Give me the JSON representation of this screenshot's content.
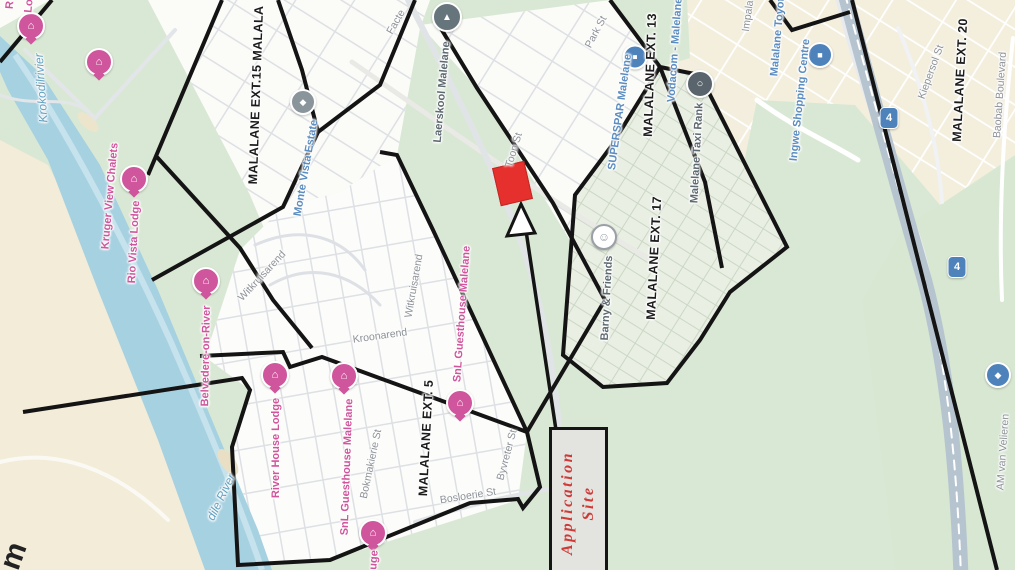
{
  "title": "Malalane locality map with application site",
  "canvas": {
    "width": 1015,
    "height": 570
  },
  "map": {
    "road_shield": "4",
    "annotation": {
      "line1": "Application",
      "line2": "Site"
    },
    "colors": {
      "site_marker": "#e6302d",
      "annotation_text": "#cf3a37",
      "boundary": "#141414",
      "river": "#a6d1e1",
      "green": "#d9e8d4",
      "sand": "#f2ecd9",
      "lodge_pink": "#cf559c",
      "business_blue": "#5c8dc0",
      "street_gray": "#8d9298",
      "highway": "#b6c4d0"
    },
    "labels": [
      {
        "name": "label-ext15",
        "cls": "ext",
        "text": "MALALANE EXT.15 MALALA",
        "x": 256,
        "y": 95,
        "rot": -88
      },
      {
        "name": "label-ext13",
        "cls": "ext",
        "text": "MALALANE EXT. 13",
        "x": 650,
        "y": 75,
        "rot": -88
      },
      {
        "name": "label-ext17",
        "cls": "ext",
        "text": "MALALANE EXT. 17",
        "x": 654,
        "y": 258,
        "rot": -87
      },
      {
        "name": "label-ext20",
        "cls": "ext",
        "text": "MALALANE EXT. 20",
        "x": 960,
        "y": 80,
        "rot": -87
      },
      {
        "name": "label-ext5",
        "cls": "ext",
        "text": "MALALANE EXT. 5",
        "x": 426,
        "y": 438,
        "rot": -87
      },
      {
        "name": "label-kroonarend",
        "cls": "street",
        "text": "Kroonarend",
        "x": 380,
        "y": 336,
        "rot": -8
      },
      {
        "name": "label-witkruisarend-west",
        "cls": "street",
        "text": "Witkruisarend",
        "x": 262,
        "y": 276,
        "rot": -47
      },
      {
        "name": "label-witkruisarend-east",
        "cls": "street",
        "text": "Witkruisarend",
        "x": 414,
        "y": 286,
        "rot": -80
      },
      {
        "name": "label-bokmakierie-st",
        "cls": "street",
        "text": "Bokmakierie St",
        "x": 371,
        "y": 464,
        "rot": -78
      },
      {
        "name": "label-bosloerie-st",
        "cls": "street",
        "text": "Bosloerie St",
        "x": 468,
        "y": 496,
        "rot": -9
      },
      {
        "name": "label-byvreter-st",
        "cls": "street",
        "text": "Byvreter St",
        "x": 507,
        "y": 455,
        "rot": -75
      },
      {
        "name": "label-toon-st",
        "cls": "street",
        "text": "Toon St",
        "x": 514,
        "y": 150,
        "rot": -73
      },
      {
        "name": "label-park-st",
        "cls": "street",
        "text": "Park St",
        "x": 596,
        "y": 32,
        "rot": -62
      },
      {
        "name": "label-impala-st",
        "cls": "street",
        "text": "Impala",
        "x": 748,
        "y": 16,
        "rot": -82
      },
      {
        "name": "label-kiepersol-st",
        "cls": "street",
        "text": "Kiepersol St",
        "x": 931,
        "y": 72,
        "rot": -70
      },
      {
        "name": "label-baobab-boulevard",
        "cls": "street",
        "text": "Baobab Boulevard",
        "x": 1000,
        "y": 95,
        "rot": -86
      },
      {
        "name": "label-am-van-velieren",
        "cls": "street",
        "text": "AM van Velieren",
        "x": 1003,
        "y": 452,
        "rot": -86
      },
      {
        "name": "label-road-fragment",
        "cls": "street",
        "text": "Facte",
        "x": 396,
        "y": 22,
        "rot": -60
      },
      {
        "name": "label-krokodilrivier",
        "cls": "water",
        "text": "Krokodilrivier",
        "x": 41,
        "y": 88,
        "rot": -94
      },
      {
        "name": "label-crocodile-river",
        "cls": "water",
        "text": "dile River",
        "x": 221,
        "y": 497,
        "rot": -64
      },
      {
        "name": "label-kruger-view-chalets",
        "cls": "pink",
        "text": "Kruger View Chalets",
        "x": 110,
        "y": 196,
        "rot": -85
      },
      {
        "name": "label-rio-vista-lodge",
        "cls": "pink",
        "text": "Rio Vista Lodge",
        "x": 134,
        "y": 242,
        "rot": -87
      },
      {
        "name": "label-belvedere-on-river",
        "cls": "pink",
        "text": "Belvedere-on-River",
        "x": 206,
        "y": 356,
        "rot": -89
      },
      {
        "name": "label-river-house-lodge",
        "cls": "pink",
        "text": "River House Lodge",
        "x": 276,
        "y": 448,
        "rot": -90
      },
      {
        "name": "label-snl-guesthouse-west",
        "cls": "pink",
        "text": "SnL Guesthouse Malelane",
        "x": 347,
        "y": 467,
        "rot": -88
      },
      {
        "name": "label-snl-guesthouse-east",
        "cls": "pink",
        "text": "SnL Guesthouse Malelane",
        "x": 462,
        "y": 314,
        "rot": -86
      },
      {
        "name": "label-lodge-fragment",
        "cls": "pink",
        "text": "uge",
        "x": 374,
        "y": 560,
        "rot": -86
      },
      {
        "name": "label-corner-fragment-r",
        "cls": "pink",
        "text": "R",
        "x": 10,
        "y": 5,
        "rot": -85
      },
      {
        "name": "label-corner-fragment-lo",
        "cls": "pink",
        "text": "Lo",
        "x": 29,
        "y": 6,
        "rot": -85
      },
      {
        "name": "label-monte-vista-estate",
        "cls": "biz",
        "text": "Monte Vista Estate",
        "x": 306,
        "y": 168,
        "rot": -80
      },
      {
        "name": "label-superspar",
        "cls": "biz",
        "text": "SUPERSPAR Malelane",
        "x": 620,
        "y": 112,
        "rot": -82
      },
      {
        "name": "label-vodacom",
        "cls": "biz",
        "text": "Vodacom - Malelane",
        "x": 675,
        "y": 50,
        "rot": -86
      },
      {
        "name": "label-malalane-toyota",
        "cls": "biz",
        "text": "Malalane Toyota",
        "x": 778,
        "y": 34,
        "rot": -85
      },
      {
        "name": "label-ingwe-shopping-centre",
        "cls": "biz",
        "text": "Ingwe Shopping Centre",
        "x": 800,
        "y": 100,
        "rot": -84
      },
      {
        "name": "label-laerskool-malelane",
        "cls": "poi",
        "text": "Laerskool Malelane",
        "x": 442,
        "y": 92,
        "rot": -85
      },
      {
        "name": "label-malelane-taxi-rank",
        "cls": "poi",
        "text": "Malelane Taxi Rank",
        "x": 697,
        "y": 153,
        "rot": -87
      },
      {
        "name": "label-barny-and-friends",
        "cls": "poi",
        "text": "Barny & Friends",
        "x": 607,
        "y": 298,
        "rot": -87
      },
      {
        "name": "label-edge-fragment-m",
        "cls": "bigfrag",
        "text": "m",
        "x": 14,
        "y": 556,
        "rot": -70
      }
    ],
    "icons": [
      {
        "name": "lodge-icon",
        "type": "lodge",
        "x": 31,
        "y": 26
      },
      {
        "name": "lodge-icon",
        "type": "lodge",
        "x": 99,
        "y": 62
      },
      {
        "name": "lodge-icon",
        "type": "lodge",
        "x": 134,
        "y": 179
      },
      {
        "name": "lodge-icon",
        "type": "lodge",
        "x": 206,
        "y": 281
      },
      {
        "name": "lodge-icon",
        "type": "lodge",
        "x": 275,
        "y": 375
      },
      {
        "name": "lodge-icon",
        "type": "lodge",
        "x": 344,
        "y": 376
      },
      {
        "name": "lodge-icon",
        "type": "lodge",
        "x": 460,
        "y": 403
      },
      {
        "name": "lodge-icon",
        "type": "lodge",
        "x": 373,
        "y": 533
      },
      {
        "name": "school-icon",
        "type": "school",
        "x": 447,
        "y": 17
      },
      {
        "name": "estate-icon",
        "type": "mv",
        "x": 303,
        "y": 102
      },
      {
        "name": "supermarket-icon",
        "type": "store",
        "x": 635,
        "y": 57
      },
      {
        "name": "shopping-bag-icon",
        "type": "bag",
        "x": 820,
        "y": 55
      },
      {
        "name": "taxi-rank-icon",
        "type": "taxi",
        "x": 700,
        "y": 84
      },
      {
        "name": "playpark-icon",
        "type": "barny",
        "x": 604,
        "y": 237
      },
      {
        "name": "n4-route-shield",
        "type": "shield",
        "x": 889,
        "y": 118
      },
      {
        "name": "n4-route-shield",
        "type": "shield",
        "x": 957,
        "y": 267
      },
      {
        "name": "poi-icon",
        "type": "poi2",
        "x": 998,
        "y": 375
      }
    ]
  }
}
